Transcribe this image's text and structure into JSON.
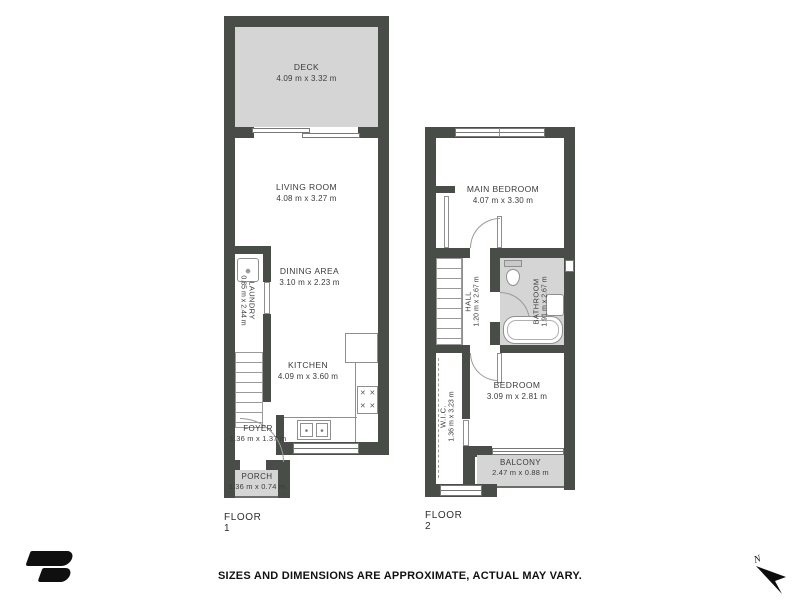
{
  "floors": [
    {
      "label": "FLOOR 1",
      "rooms": [
        {
          "name": "DECK",
          "dims": "4.09 m x 3.32 m"
        },
        {
          "name": "LIVING ROOM",
          "dims": "4.08 m x 3.27 m"
        },
        {
          "name": "DINING AREA",
          "dims": "3.10 m x 2.23 m"
        },
        {
          "name": "LAUNDRY",
          "dims": "0.85 m x 2.44 m"
        },
        {
          "name": "KITCHEN",
          "dims": "4.09 m x 3.60 m"
        },
        {
          "name": "FOYER",
          "dims": "1.36 m x 1.37 m"
        },
        {
          "name": "PORCH",
          "dims": "1.36 m x 0.74 m"
        }
      ]
    },
    {
      "label": "FLOOR 2",
      "rooms": [
        {
          "name": "MAIN BEDROOM",
          "dims": "4.07 m x 3.30 m"
        },
        {
          "name": "HALL",
          "dims": "1.20 m x 2.67 m"
        },
        {
          "name": "BATHROOM",
          "dims": "1.91 m x 2.67 m"
        },
        {
          "name": "BEDROOM",
          "dims": "3.09 m x 2.81 m"
        },
        {
          "name": "W.I.C.",
          "dims": "1.36 m x 3.23 m"
        },
        {
          "name": "BALCONY",
          "dims": "2.47 m x 0.88 m"
        }
      ]
    }
  ],
  "footer": {
    "disclaimer": "SIZES AND DIMENSIONS ARE APPROXIMATE, ACTUAL MAY VARY."
  },
  "compass": {
    "label": "N"
  },
  "icons": {
    "burner": "✕"
  },
  "colors": {
    "wall": "#484d48",
    "outdoor_fill": "#d4d5d4",
    "line": "#8f8f8f",
    "text": "#3b3b3b"
  }
}
